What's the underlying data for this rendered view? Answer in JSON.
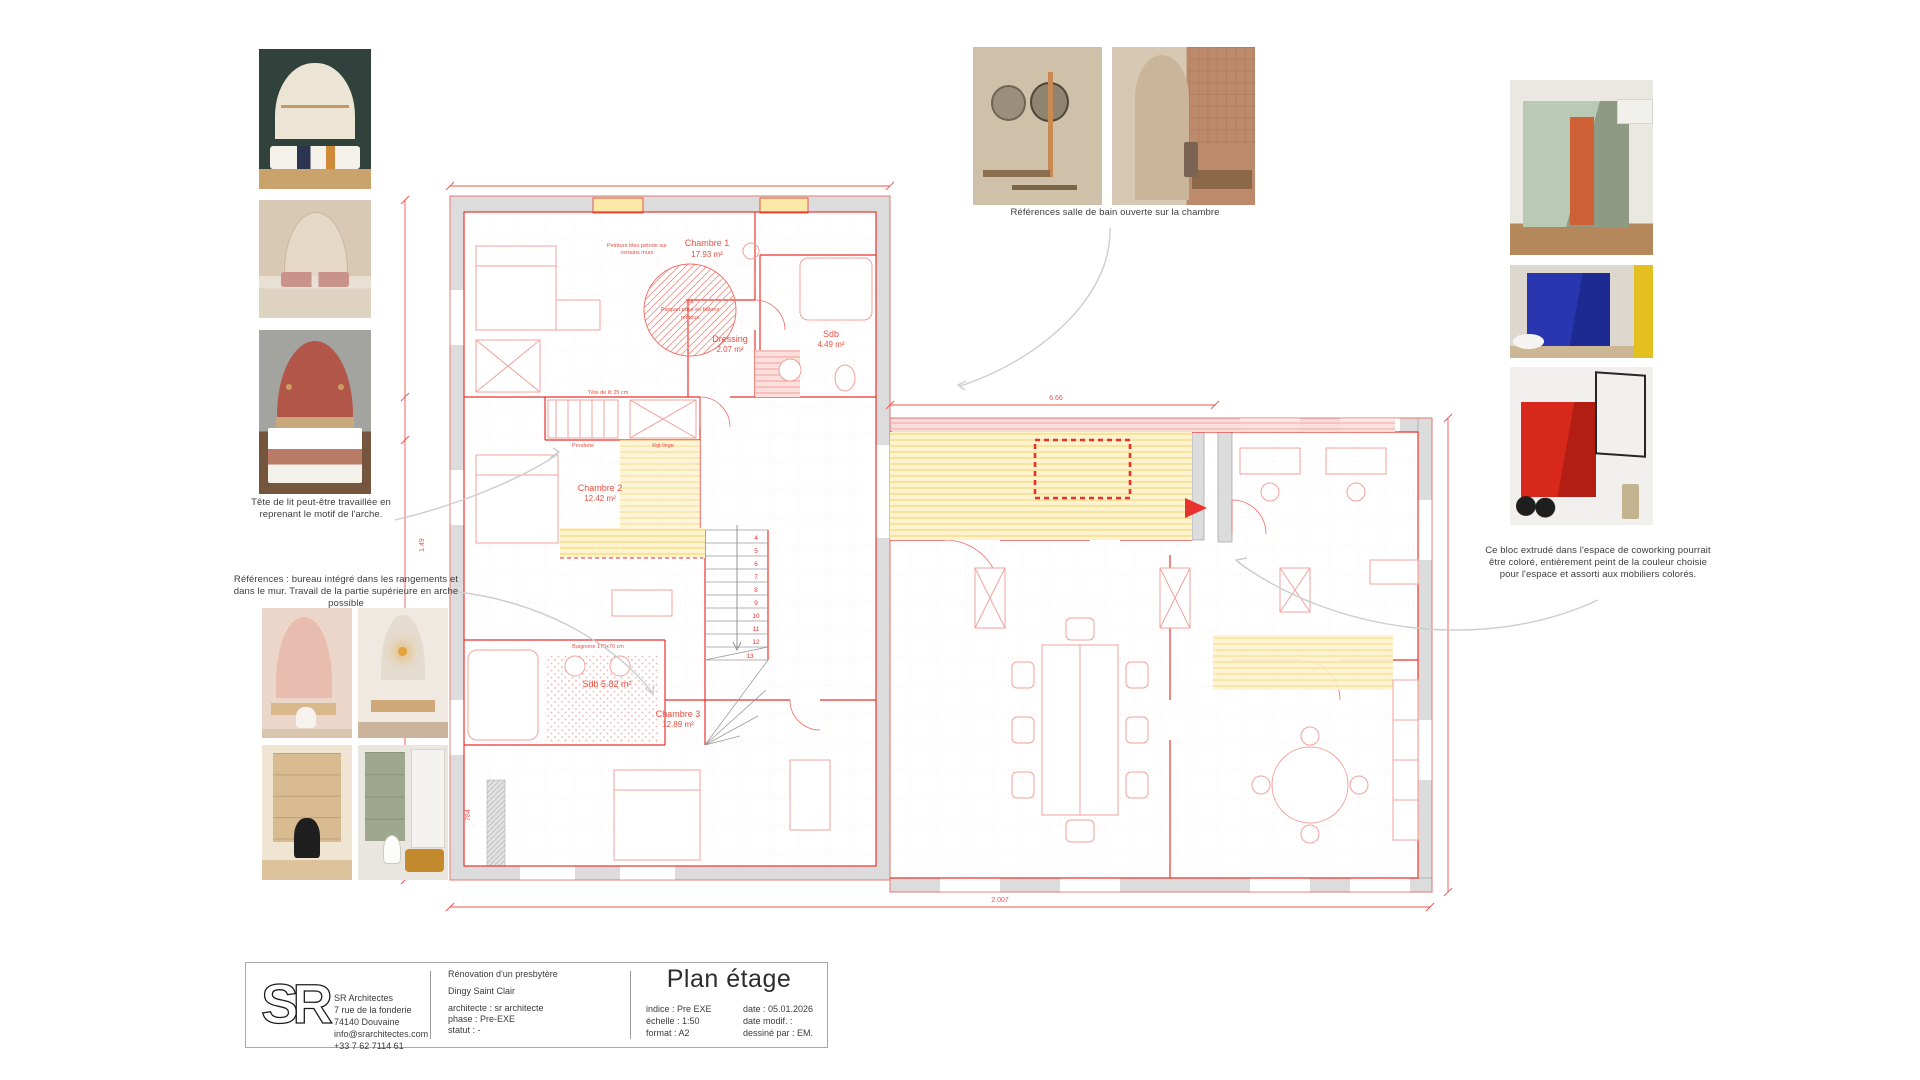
{
  "sheet_colors": {
    "accent_red": "#e8322e",
    "wall_gray": "#dcdcdc",
    "highlight_yellow": "#fdf0c0",
    "hatch_pink": "#f8d7d5",
    "arrow_gray": "#cdcdcd"
  },
  "captions": {
    "left_bed": "Tête de lit peut-être travaillée en reprenant le motif de l'arche.",
    "left_desk": "Références : bureau intégré dans les rangements et dans le mur. Travail de la partie supérieure en arche possible",
    "top_bath": "Références salle de bain ouverte sur la chambre",
    "right_block": "Ce bloc extrudé dans l'espace de coworking pourrait être coloré, entièrement peint de la couleur choisie pour l'espace et assorti aux mobiliers colorés."
  },
  "title_block": {
    "company": {
      "logo_text": "SR",
      "name": "SR Architectes",
      "address_line1": "7 rue de la fonderie",
      "address_line2": "74140 Douvaine",
      "email": "info@srarchitectes.com",
      "phone": "+33 7 62 7114 61"
    },
    "project": {
      "title": "Rénovation d'un presbytère",
      "location": "Dingy Saint Clair",
      "architect": "architecte : sr architecte",
      "phase": "phase : Pre-EXE",
      "status": "statut : -"
    },
    "sheet": {
      "title": "Plan étage",
      "indice": "indice : Pre EXE",
      "scale": "échelle : 1:50",
      "format": "format : A2",
      "date": "date : 05.01.2026",
      "date_modif": "date modif. :",
      "drawn_by": "dessiné par : EM."
    }
  },
  "plan": {
    "rooms": [
      {
        "name": "Chambre 1",
        "area": "17.93 m²"
      },
      {
        "name": "Dressing",
        "area": "2.07 m²"
      },
      {
        "name": "Sdb",
        "area": "4.49 m²"
      },
      {
        "name": "Chambre 2",
        "area": "12.42 m²"
      },
      {
        "name": "Sdb 5.82 m²",
        "area": ""
      },
      {
        "name": "Chambre 3",
        "area": "12.89 m²"
      }
    ],
    "notes": {
      "paint_1": "Peinture bleu pétrole sur",
      "paint_2": "certains murs",
      "floor_1": "Sol:",
      "floor_2": "Parquet posé en bâtons",
      "floor_3": "rompus"
    },
    "small_labels": {
      "headboard": "Tête de lit 25 cm",
      "penderie": "Penderie",
      "rgt_linge": "Rgt linge",
      "bathtub": "Baignoire 170x70 cm"
    },
    "stairs": {
      "steps": [
        "4",
        "5",
        "6",
        "7",
        "8",
        "9",
        "10",
        "11",
        "12",
        "13"
      ]
    },
    "dimensions": {
      "bottom": "2.007",
      "top_right": "6.66",
      "left_a": "784",
      "left_b": "1.49"
    }
  }
}
